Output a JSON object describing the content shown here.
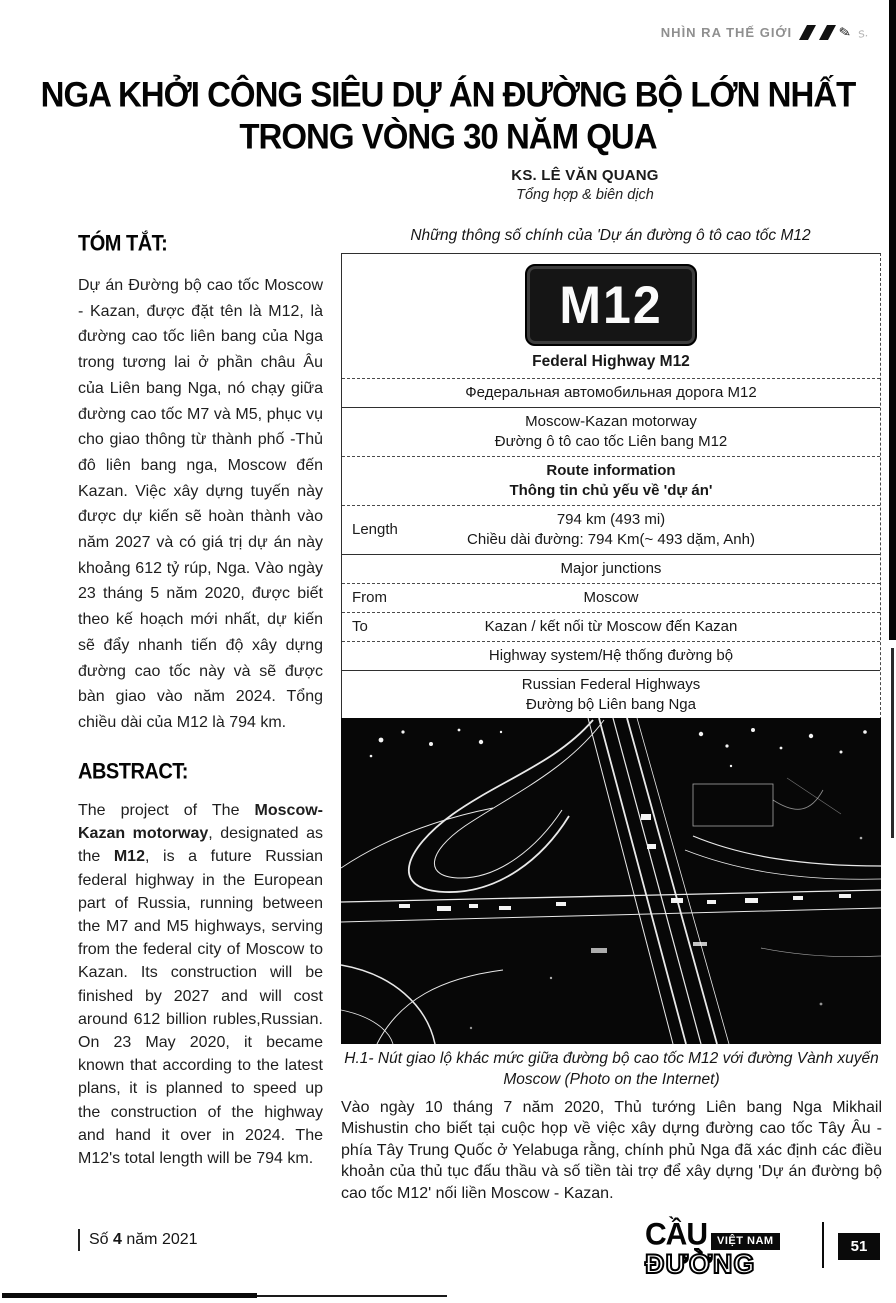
{
  "header": {
    "section_label": "NHÌN RA THẾ GIỚI"
  },
  "title": {
    "line1": "NGA KHỞI CÔNG SIÊU DỰ ÁN ĐƯỜNG BỘ LỚN NHẤT",
    "line2": "TRONG VÒNG 30 NĂM QUA"
  },
  "author": {
    "name": "KS. LÊ VĂN QUANG",
    "role": "Tổng hợp & biên dịch"
  },
  "summary": {
    "heading": "TÓM TẮT:",
    "body": "Dự án Đường bộ cao tốc Moscow - Kazan, được đặt tên là M12, là đường cao tốc liên bang của Nga trong tương lai ở phần châu Âu của Liên bang Nga, nó chạy giữa đường cao tốc M7 và M5, phục vụ cho giao thông từ thành phố -Thủ đô liên bang nga, Moscow đến Kazan. Việc xây dựng tuyến này được dự kiến sẽ hoàn thành vào năm 2027 và có giá trị dự án này khoảng 612 tỷ rúp, Nga. Vào ngày 23 tháng 5 năm 2020, được biết theo kế hoạch mới nhất, dự kiến sẽ đẩy nhanh tiến độ xây dựng đường cao tốc này và sẽ được bàn giao vào năm 2024. Tổng chiều dài của M12 là 794 km."
  },
  "abstract": {
    "heading": "ABSTRACT:",
    "seg1": "The project of The ",
    "seg2_bold": "Moscow-Kazan motorway",
    "seg3": ", designated as the ",
    "seg4_bold": "M12",
    "seg5": ", is a future Russian federal highway in the European part of Russia, running between the M7 and M5 highways, serving from the federal city of Moscow to Kazan. Its construction will be finished by 2027 and will cost around 612 billion rubles,Russian. On 23 May 2020, it became known that according to the latest plans, it is planned to speed up the construction of the highway and hand it over in 2024. The M12's total length will be 794 km."
  },
  "infobox": {
    "caption": "Những thông số chính của 'Dự án đường ô tô cao tốc M12",
    "badge_text": "M12",
    "badge_label": "Federal Highway M12",
    "russian_name": "Федеральная автомобильная дорога М12",
    "name_en": "Moscow-Kazan motorway",
    "name_vi": "Đường ô tô cao tốc Liên bang M12",
    "route_info_en": "Route information",
    "route_info_vi": "Thông tin chủ yếu về 'dự án'",
    "length_label": "Length",
    "length_en": "794 km (493 mi)",
    "length_vi": "Chiều dài đường: 794 Km(~ 493 dặm, Anh)",
    "junctions_header": "Major junctions",
    "from_label": "From",
    "from_value": "Moscow",
    "to_label": "To",
    "to_value": "Kazan / kết nối từ Moscow đến Kazan",
    "system_header": "Highway system/Hệ thống đường bộ",
    "system_en": "Russian Federal Highways",
    "system_vi": "Đường bộ Liên bang Nga"
  },
  "figure": {
    "caption": "H.1- Nút giao lộ khác mức giữa đường bộ cao tốc M12 với đường Vành xuyến Moscow (Photo on the Internet)"
  },
  "body_paragraph": "Vào ngày 10 tháng 7 năm 2020, Thủ tướng Liên bang Nga Mikhail Mishustin cho biết tại cuộc họp về việc xây dựng đường cao tốc Tây Âu - phía Tây Trung Quốc ở Yelabuga rằng, chính phủ Nga đã xác định các điều khoản của thủ tục đấu thầu và số tiền tài trợ để xây dựng 'Dự án đường bộ cao tốc M12' nối liền Moscow - Kazan.",
  "footer": {
    "issue_prefix": "Số ",
    "issue_number": "4",
    "issue_suffix": " năm 2021",
    "logo_top": "CẦU",
    "logo_badge": "VIỆT NAM",
    "logo_bottom": "ĐƯỜNG",
    "page_number": "51"
  },
  "colors": {
    "text": "#1b1b1b",
    "header_gray": "#8f8f8f",
    "badge_bg": "#151515"
  }
}
